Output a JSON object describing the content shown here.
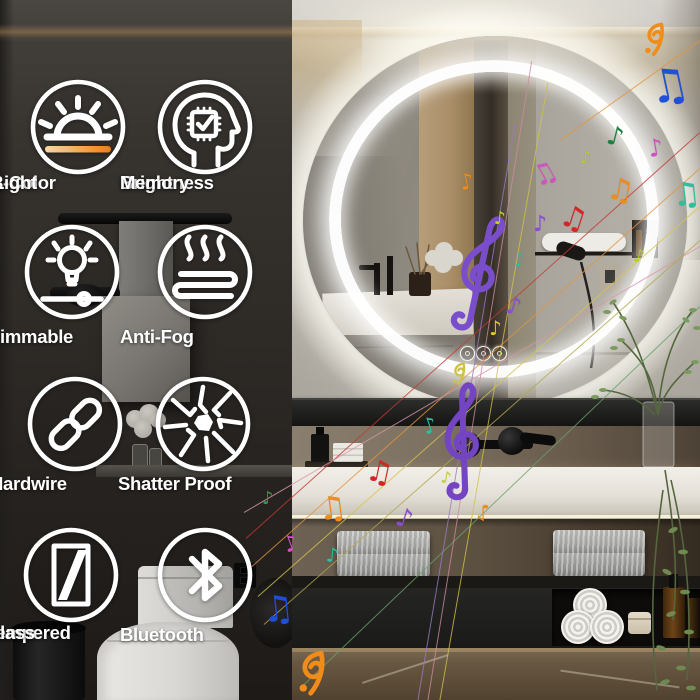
{
  "product_overlay": {
    "features": [
      {
        "name": "three-color-light",
        "line1": "3-Color",
        "line2": "Light"
      },
      {
        "name": "brightness-memory",
        "line1": "Brightness",
        "line2": "Memory"
      },
      {
        "name": "dimmable",
        "line1": "Dimmable",
        "line2": ""
      },
      {
        "name": "anti-fog",
        "line1": "Anti-Fog",
        "line2": ""
      },
      {
        "name": "hardwire",
        "line1": "Hardwire",
        "line2": ""
      },
      {
        "name": "shatter-proof",
        "line1": "Shatter Proof",
        "line2": ""
      },
      {
        "name": "tempered-glass",
        "line1": "Tempered",
        "line2": "Glass"
      },
      {
        "name": "bluetooth",
        "line1": "Bluetooth",
        "line2": ""
      }
    ],
    "colors": {
      "icon_white": "#ffffff",
      "accent_orange": "#ee7d12",
      "led_white": "#ffffff",
      "clef_purple": "#7a4ecb"
    }
  },
  "music": {
    "clefs": [
      {
        "x": 449,
        "y": 206,
        "h": 126,
        "rot": 8,
        "c": "#7a4ecb"
      },
      {
        "x": 432,
        "y": 376,
        "h": 124,
        "rot": -6,
        "c": "#7445c2"
      }
    ],
    "notes": [
      {
        "x": 648,
        "y": 62,
        "s": 46,
        "r": -12,
        "c": "#2050d8",
        "g": "d"
      },
      {
        "x": 607,
        "y": 124,
        "s": 26,
        "r": 14,
        "c": "#1e8040",
        "g": "s"
      },
      {
        "x": 648,
        "y": 136,
        "s": 24,
        "r": -10,
        "c": "#d44fc4",
        "g": "s"
      },
      {
        "x": 580,
        "y": 150,
        "s": 17,
        "r": 0,
        "c": "#b5cf27",
        "g": "s"
      },
      {
        "x": 532,
        "y": 160,
        "s": 28,
        "r": -30,
        "c": "#cf52c0",
        "g": "d"
      },
      {
        "x": 607,
        "y": 176,
        "s": 30,
        "r": 10,
        "c": "#ef8c1a",
        "g": "d"
      },
      {
        "x": 672,
        "y": 178,
        "s": 32,
        "r": -6,
        "c": "#2ebf9d",
        "g": "d"
      },
      {
        "x": 560,
        "y": 204,
        "s": 30,
        "r": 18,
        "c": "#d32525",
        "g": "d"
      },
      {
        "x": 533,
        "y": 214,
        "s": 22,
        "r": 0,
        "c": "#8a4fd0",
        "g": "s"
      },
      {
        "x": 633,
        "y": 248,
        "s": 18,
        "r": 10,
        "c": "#b5cf27",
        "g": "s"
      },
      {
        "x": 460,
        "y": 172,
        "s": 22,
        "r": -12,
        "c": "#ef8c1a",
        "g": "s"
      },
      {
        "x": 494,
        "y": 210,
        "s": 18,
        "r": 4,
        "c": "#c3cf2a",
        "g": "s"
      },
      {
        "x": 514,
        "y": 252,
        "s": 18,
        "r": -8,
        "c": "#2ebf9d",
        "g": "s"
      },
      {
        "x": 506,
        "y": 294,
        "s": 24,
        "r": 14,
        "c": "#8a4fd0",
        "g": "s"
      },
      {
        "x": 489,
        "y": 318,
        "s": 20,
        "r": 0,
        "c": "#e0c81e",
        "g": "s"
      },
      {
        "x": 476,
        "y": 500,
        "s": 22,
        "r": 180,
        "c": "#ef8c1a",
        "g": "s"
      },
      {
        "x": 441,
        "y": 470,
        "s": 16,
        "r": 10,
        "c": "#c3cf2a",
        "g": "s"
      },
      {
        "x": 423,
        "y": 416,
        "s": 22,
        "r": -18,
        "c": "#2ebf9d",
        "g": "s"
      },
      {
        "x": 396,
        "y": 506,
        "s": 26,
        "r": 18,
        "c": "#8a4fd0",
        "g": "s"
      },
      {
        "x": 366,
        "y": 458,
        "s": 30,
        "r": 12,
        "c": "#d32525",
        "g": "d"
      },
      {
        "x": 318,
        "y": 492,
        "s": 32,
        "r": -8,
        "c": "#ef8c1a",
        "g": "d"
      },
      {
        "x": 326,
        "y": 545,
        "s": 20,
        "r": 6,
        "c": "#2ebf9d",
        "g": "s"
      },
      {
        "x": 284,
        "y": 534,
        "s": 22,
        "r": -20,
        "c": "#d44fc4",
        "g": "s"
      },
      {
        "x": 262,
        "y": 490,
        "s": 18,
        "r": 0,
        "c": "#2f9a4e",
        "g": "s"
      },
      {
        "x": 262,
        "y": 592,
        "s": 36,
        "r": -6,
        "c": "#1f4fd8",
        "g": "d"
      }
    ],
    "curls": [
      {
        "x": 644,
        "y": 22,
        "s": 24,
        "c": "#ef8c1a"
      },
      {
        "x": 298,
        "y": 650,
        "s": 32,
        "c": "#ef8c1a"
      },
      {
        "x": 452,
        "y": 362,
        "s": 16,
        "c": "#cfc24a"
      }
    ],
    "lines": [
      {
        "x1": 246,
        "y1": 538,
        "x2": 700,
        "y2": 132,
        "c": "#c23a33"
      },
      {
        "x1": 252,
        "y1": 566,
        "x2": 700,
        "y2": 168,
        "c": "#e2953f"
      },
      {
        "x1": 258,
        "y1": 596,
        "x2": 700,
        "y2": 206,
        "c": "#d4c44e"
      },
      {
        "x1": 244,
        "y1": 512,
        "x2": 700,
        "y2": 246,
        "c": "#d897aa"
      },
      {
        "x1": 264,
        "y1": 624,
        "x2": 700,
        "y2": 240,
        "c": "#b0a84e"
      },
      {
        "x1": 300,
        "y1": 688,
        "x2": 700,
        "y2": 306,
        "c": "#69a06a"
      },
      {
        "x1": 428,
        "y1": 700,
        "x2": 532,
        "y2": 60,
        "c": "#d08a9e"
      },
      {
        "x1": 440,
        "y1": 700,
        "x2": 548,
        "y2": 82,
        "c": "#cfc24a"
      },
      {
        "x1": 418,
        "y1": 700,
        "x2": 516,
        "y2": 118,
        "c": "#9a7ac0"
      },
      {
        "x1": 560,
        "y1": 140,
        "x2": 700,
        "y2": 40,
        "c": "#e2953f"
      }
    ]
  }
}
